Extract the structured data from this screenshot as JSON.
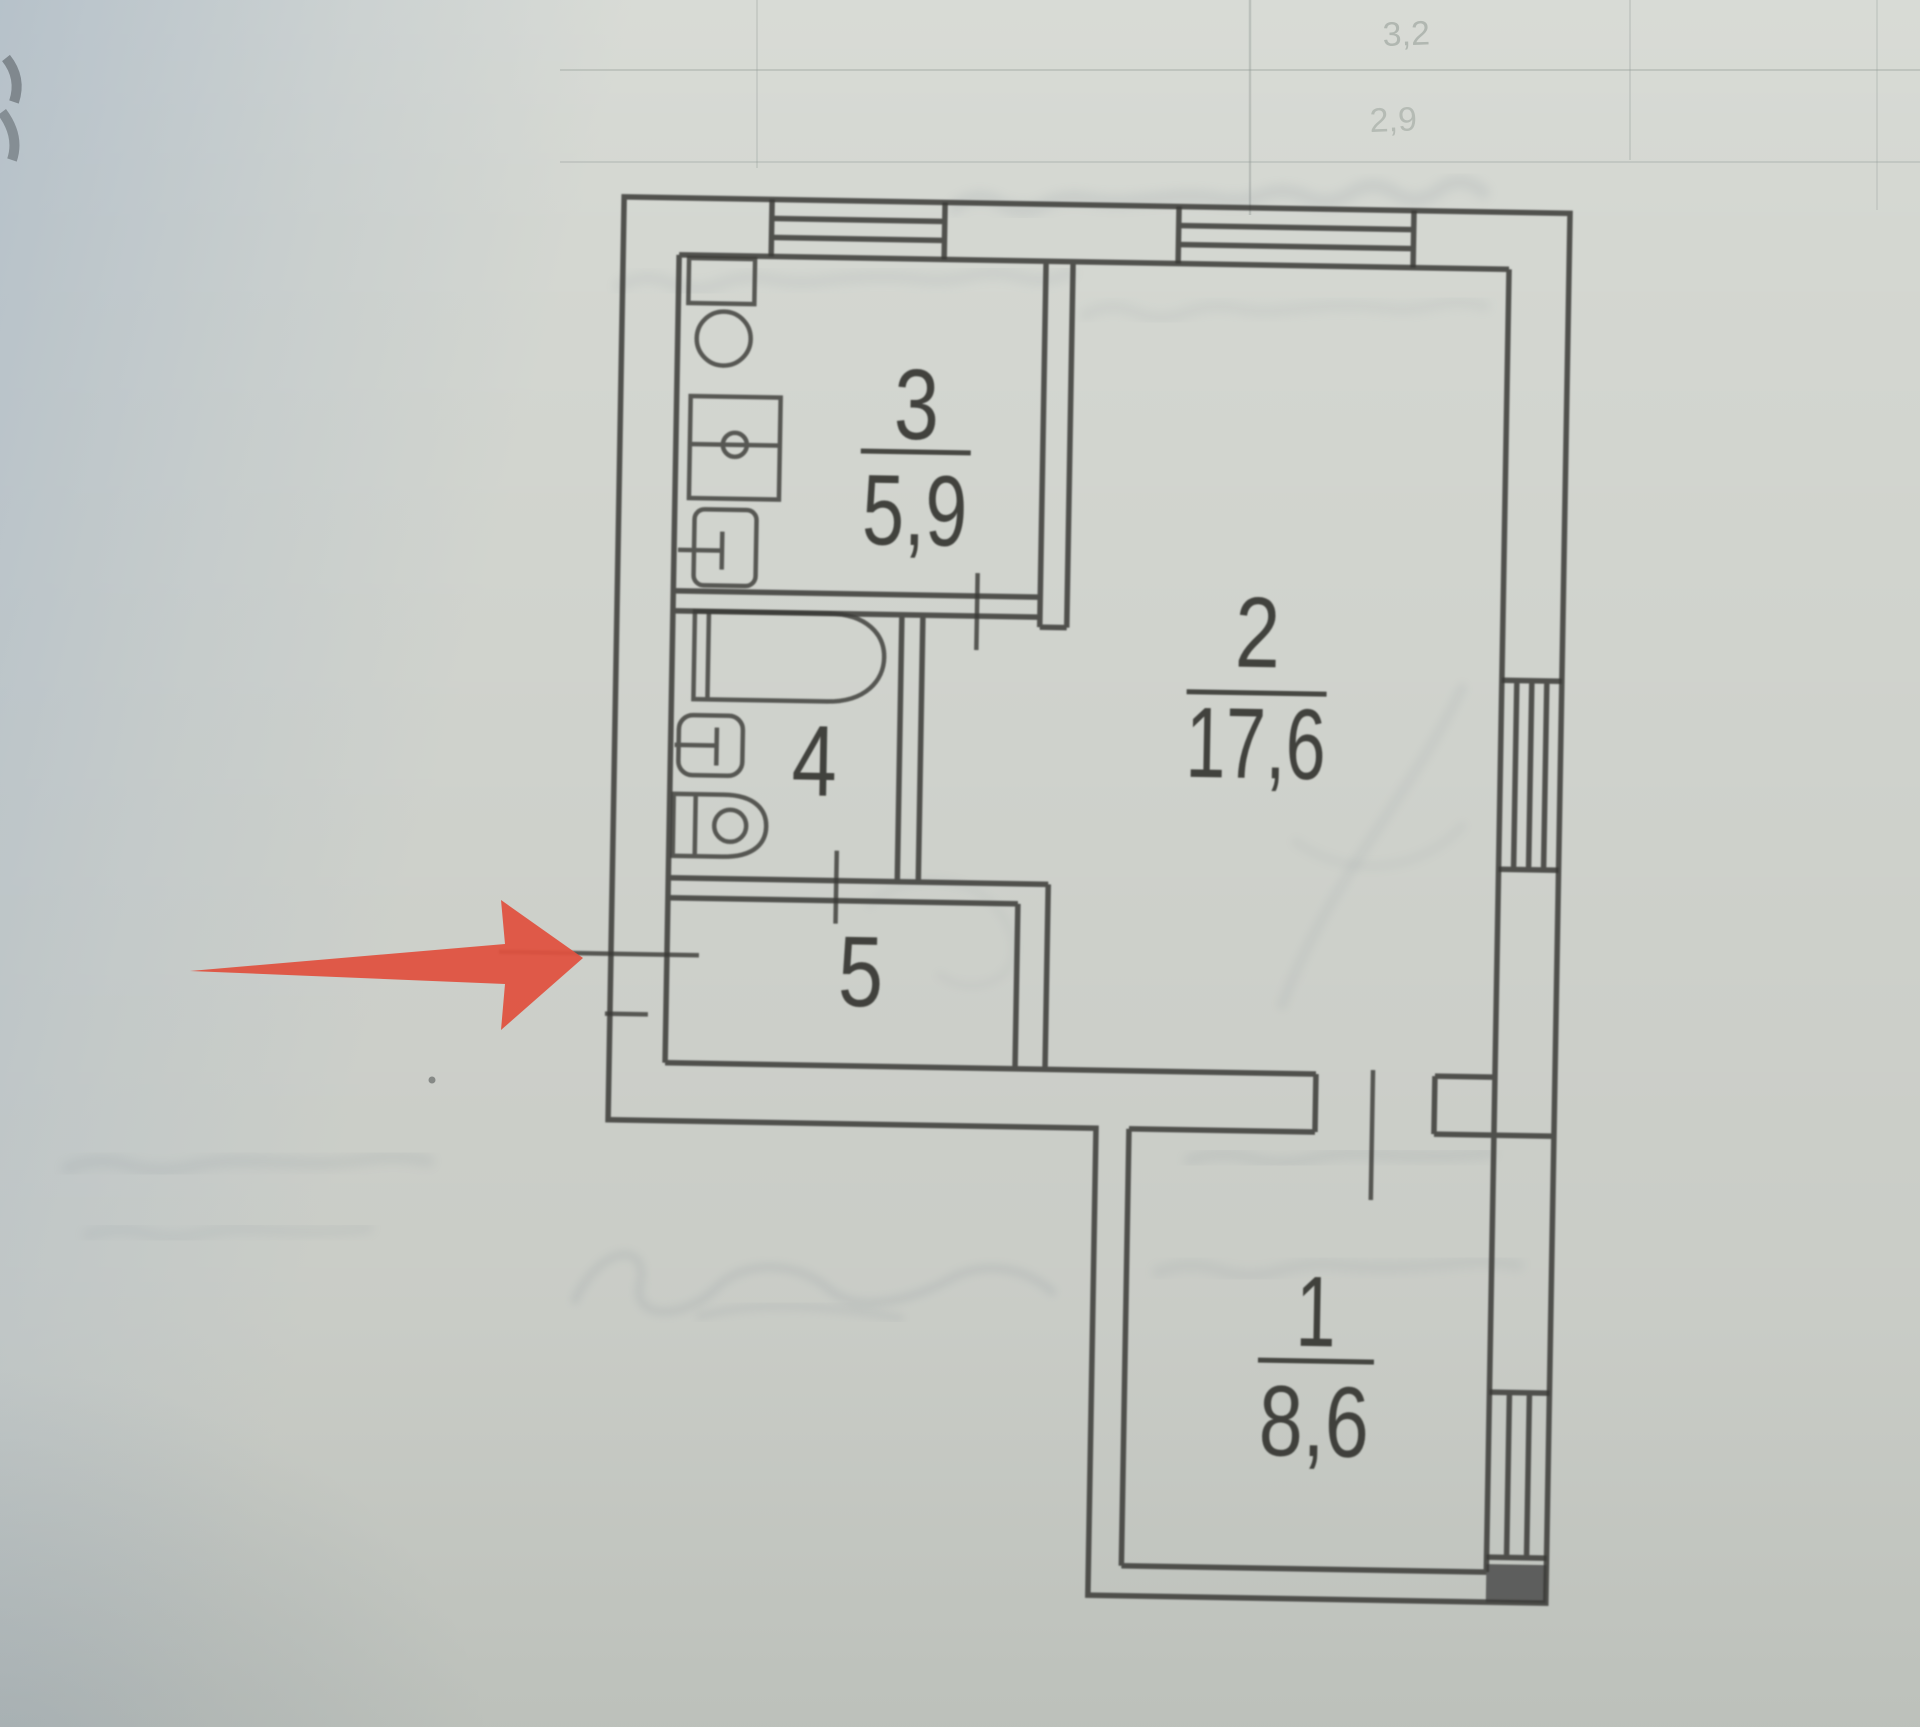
{
  "page": {
    "kind": "photographed floor plan document",
    "description": "BTI apartment floor plan scan with red arrow annotation"
  },
  "palette": {
    "paper": "#d4d7d1",
    "ink": "#3a3a36",
    "shadow_blue": "#abb9c6",
    "bleed_gray": "#76818c",
    "arrow_red": "#df5240"
  },
  "plan": {
    "rooms": [
      {
        "number": "1",
        "area": "8,6"
      },
      {
        "number": "2",
        "area": "17,6"
      },
      {
        "number": "3",
        "area": "5,9"
      },
      {
        "number": "4",
        "area": ""
      },
      {
        "number": "5",
        "area": ""
      }
    ]
  },
  "background_bleed": {
    "numbers": [
      "3,2",
      "2,9"
    ]
  },
  "annotation": {
    "arrow_color": "#df5240",
    "points_at": "entrance-opening-left-wall"
  }
}
